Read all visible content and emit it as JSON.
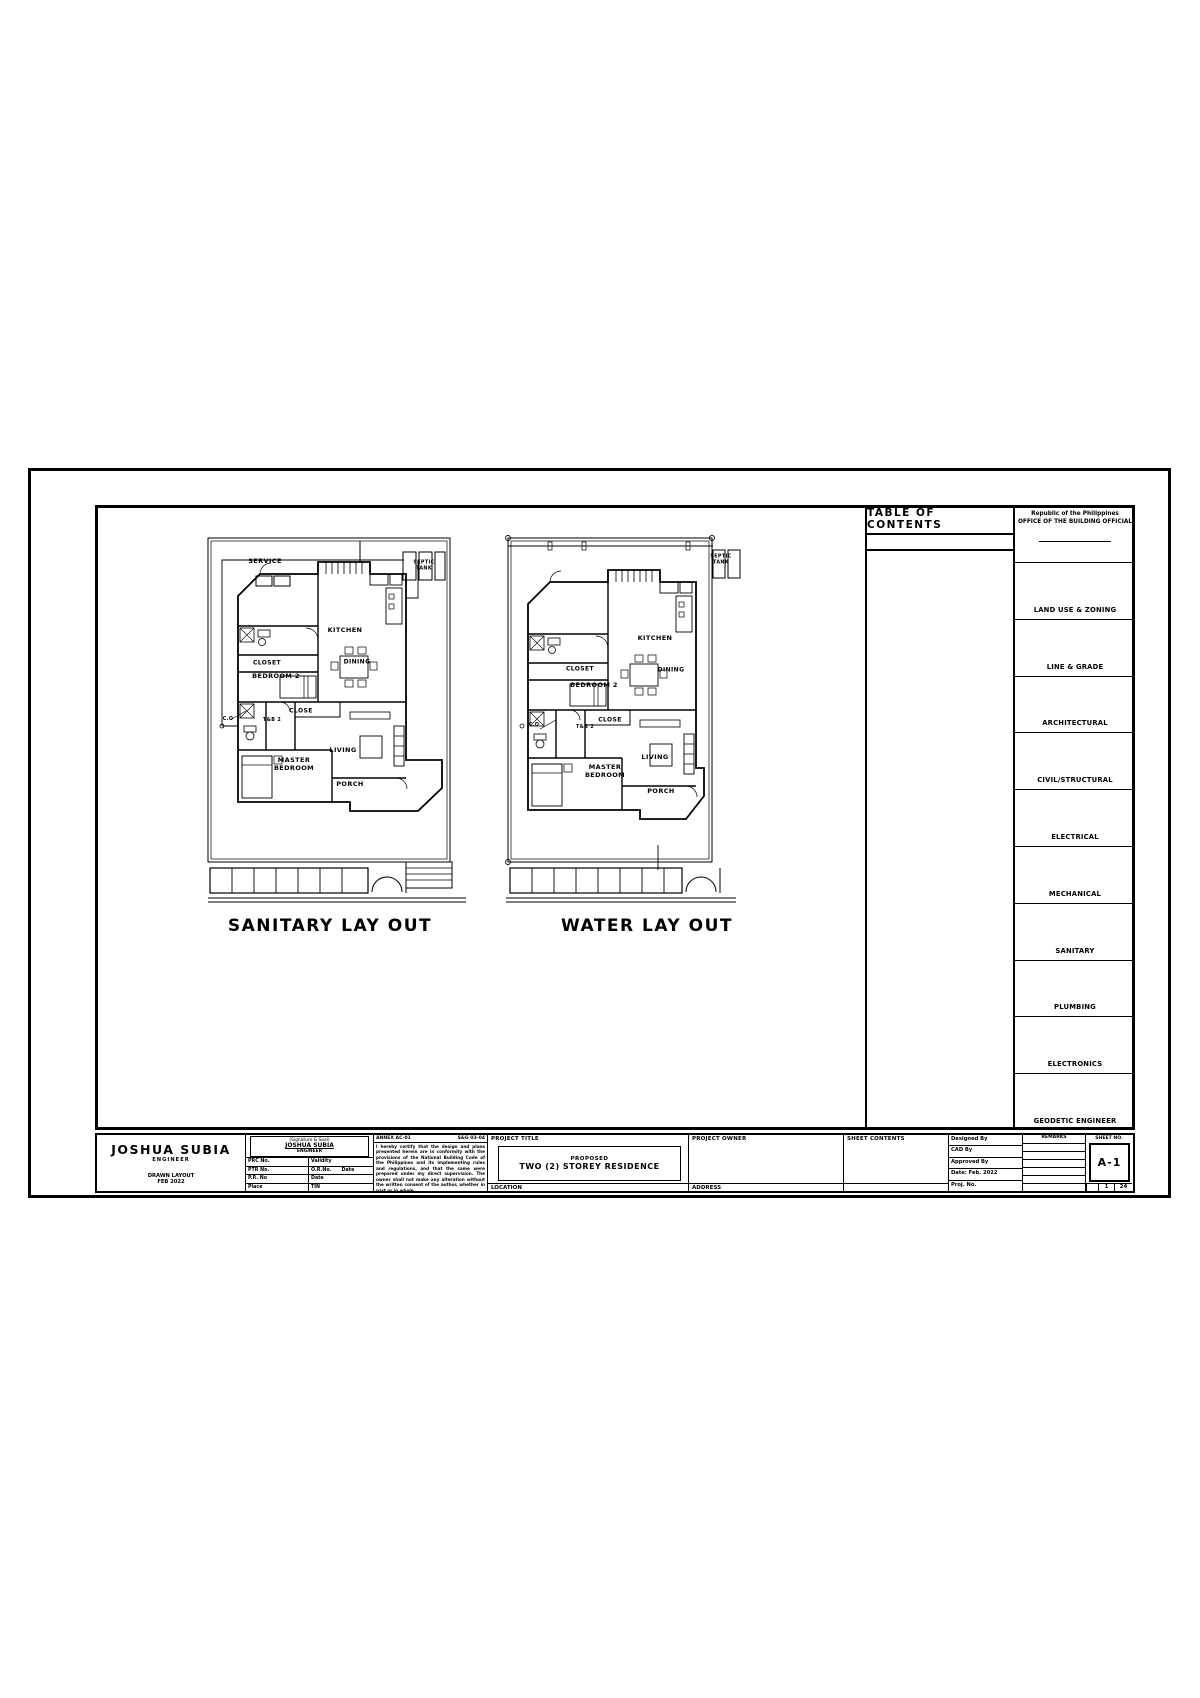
{
  "sheet": {
    "toc_title": "TABLE OF CONTENTS",
    "agency": {
      "line1": "Republic of the Philippines",
      "line2": "OFFICE OF THE BUILDING OFFICIAL"
    },
    "contents_column": {
      "items": [
        "LAND USE & ZONING",
        "LINE & GRADE",
        "ARCHITECTURAL",
        "CIVIL/STRUCTURAL",
        "ELECTRICAL",
        "MECHANICAL",
        "SANITARY",
        "PLUMBING",
        "ELECTRONICS",
        "GEODETIC ENGINEER"
      ]
    }
  },
  "plans": [
    {
      "title": "SANITARY LAY OUT",
      "labels": [
        {
          "t": "SERVICE",
          "x": 65,
          "y": 32,
          "fs": 6.5
        },
        {
          "t": "SEPTIC\nTANK",
          "x": 224,
          "y": 36,
          "fs": 4.8
        },
        {
          "t": "KITCHEN",
          "x": 145,
          "y": 101,
          "fs": 6.5
        },
        {
          "t": "DINING",
          "x": 157,
          "y": 132,
          "fs": 6
        },
        {
          "t": "CLOSET",
          "x": 67,
          "y": 133,
          "fs": 6
        },
        {
          "t": "BEDROOM 2",
          "x": 76,
          "y": 147,
          "fs": 6.5
        },
        {
          "t": "CLOSE",
          "x": 101,
          "y": 181,
          "fs": 6
        },
        {
          "t": "T&B 2",
          "x": 72,
          "y": 191,
          "fs": 4.8
        },
        {
          "t": "C.O",
          "x": 28,
          "y": 190,
          "fs": 4.8
        },
        {
          "t": "LIVING",
          "x": 143,
          "y": 221,
          "fs": 6.5
        },
        {
          "t": "MASTER\nBEDROOM",
          "x": 94,
          "y": 235,
          "fs": 6.5
        },
        {
          "t": "PORCH",
          "x": 150,
          "y": 255,
          "fs": 6.5
        }
      ]
    },
    {
      "title": "WATER LAY OUT",
      "labels": [
        {
          "t": "SEPTIC\nTANK",
          "x": 251,
          "y": 30,
          "fs": 4.8
        },
        {
          "t": "KITCHEN",
          "x": 185,
          "y": 109,
          "fs": 6.5
        },
        {
          "t": "DINING",
          "x": 201,
          "y": 140,
          "fs": 6
        },
        {
          "t": "CLOSET",
          "x": 110,
          "y": 139,
          "fs": 6
        },
        {
          "t": "BEDROOM 2",
          "x": 124,
          "y": 156,
          "fs": 6.5
        },
        {
          "t": "CLOSE",
          "x": 140,
          "y": 190,
          "fs": 6
        },
        {
          "t": "T&B 2",
          "x": 115,
          "y": 198,
          "fs": 4.8
        },
        {
          "t": "C.O",
          "x": 64,
          "y": 196,
          "fs": 4.8
        },
        {
          "t": "LIVING",
          "x": 185,
          "y": 228,
          "fs": 6.5
        },
        {
          "t": "MASTER\nBEDROOM",
          "x": 135,
          "y": 242,
          "fs": 6.5
        },
        {
          "t": "PORCH",
          "x": 191,
          "y": 262,
          "fs": 6.5
        }
      ]
    }
  ],
  "title_block": {
    "engineer": {
      "name": "JOSHUA SUBIA",
      "role": "ENGINEER",
      "line1": "DRAWN LAYOUT",
      "line2": "FEB 2022"
    },
    "signature": {
      "caption": "(Signature & Seal)",
      "name": "JOSHUA SUBIA",
      "role": "ENGINEER",
      "fields": [
        [
          "PRC No.",
          "Validity"
        ],
        [
          "PTR No.",
          "O.R.No.      Date"
        ],
        [
          "P.R. No",
          "Date"
        ],
        [
          "Place",
          "TIN"
        ]
      ]
    },
    "notes": {
      "head_left": "ANNEX AC-01",
      "head_right": "S&G 03-04",
      "body": "I hereby certify that the design and plans presented herein are in conformity with the provisions of the National Building Code of the Philippines and its implementing rules and regulations, and that the same were prepared under my direct supervision. The owner shall not make any alteration without the written consent of the author, whether in part or in whole."
    },
    "project": {
      "header": "PROJECT TITLE",
      "proposed": "PROPOSED",
      "title": "TWO (2) STOREY RESIDENCE",
      "footer": "LOCATION"
    },
    "owner": {
      "header": "PROJECT OWNER",
      "footer": "ADDRESS"
    },
    "sheet_contents": {
      "header": "SHEET CONTENTS"
    },
    "approvals": [
      "Designed By",
      "CAD By",
      "Approved By",
      "Date: Feb. 2022",
      "Proj. No."
    ],
    "revisions": {
      "header": "REMARKS"
    },
    "sheet_no": {
      "header": "SHEET NO.",
      "value": "A-1",
      "page": "1",
      "total": "24"
    }
  }
}
